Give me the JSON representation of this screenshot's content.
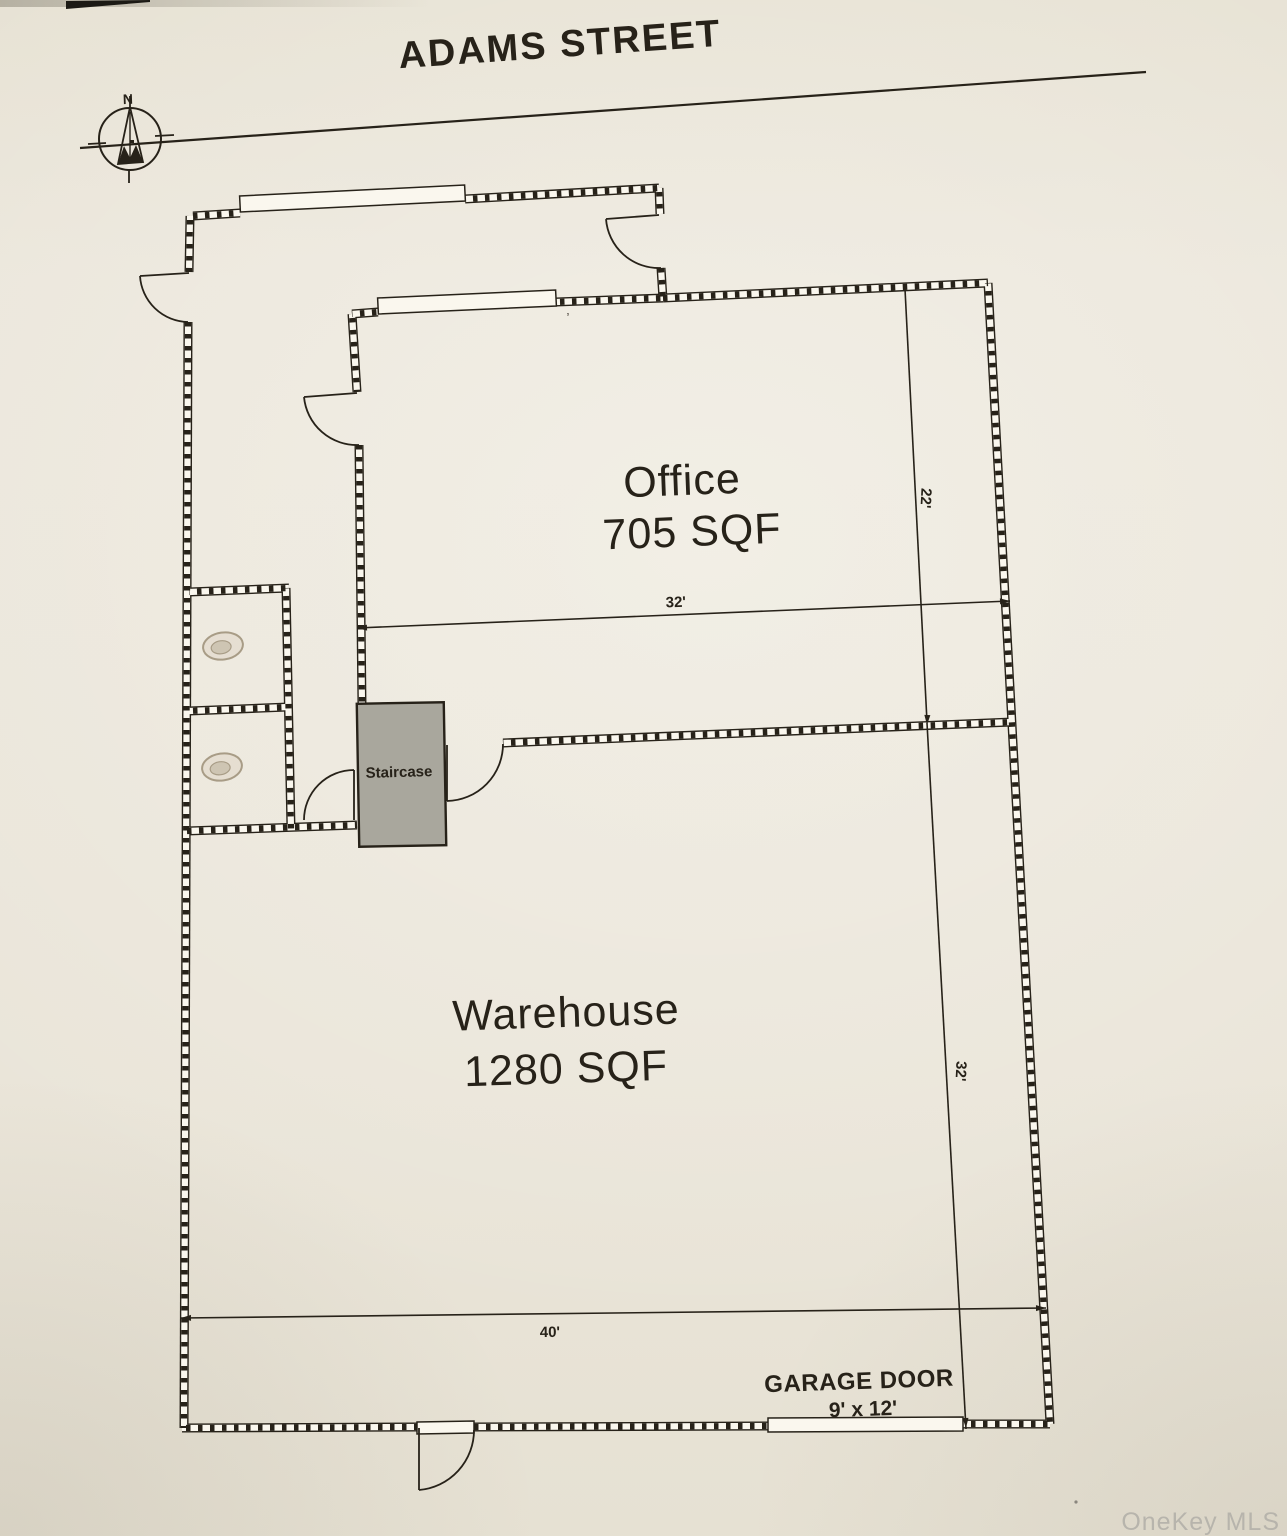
{
  "page": {
    "title": "ADAMS STREET",
    "watermark": "OneKey MLS"
  },
  "compass": {
    "north_label": "N"
  },
  "rooms": {
    "office": {
      "name": "Office",
      "area": "705 SQF"
    },
    "warehouse": {
      "name": "Warehouse",
      "area": "1280 SQF"
    },
    "staircase": {
      "name": "Staircase"
    }
  },
  "garage_door": {
    "label": "GARAGE DOOR",
    "size": "9' x 12'"
  },
  "dimensions": {
    "office_depth": "22'",
    "office_width": "32'",
    "warehouse_depth": "32'",
    "warehouse_width": "40'"
  },
  "annotations": {
    "stray_tick": "’"
  },
  "colors": {
    "paper": "#eae5d9",
    "ink": "#272219",
    "wall_core": "#faf7ee",
    "staircase_fill": "#a9a79d",
    "watermark": "#b7b4ac",
    "fixture": "#a89c86"
  }
}
